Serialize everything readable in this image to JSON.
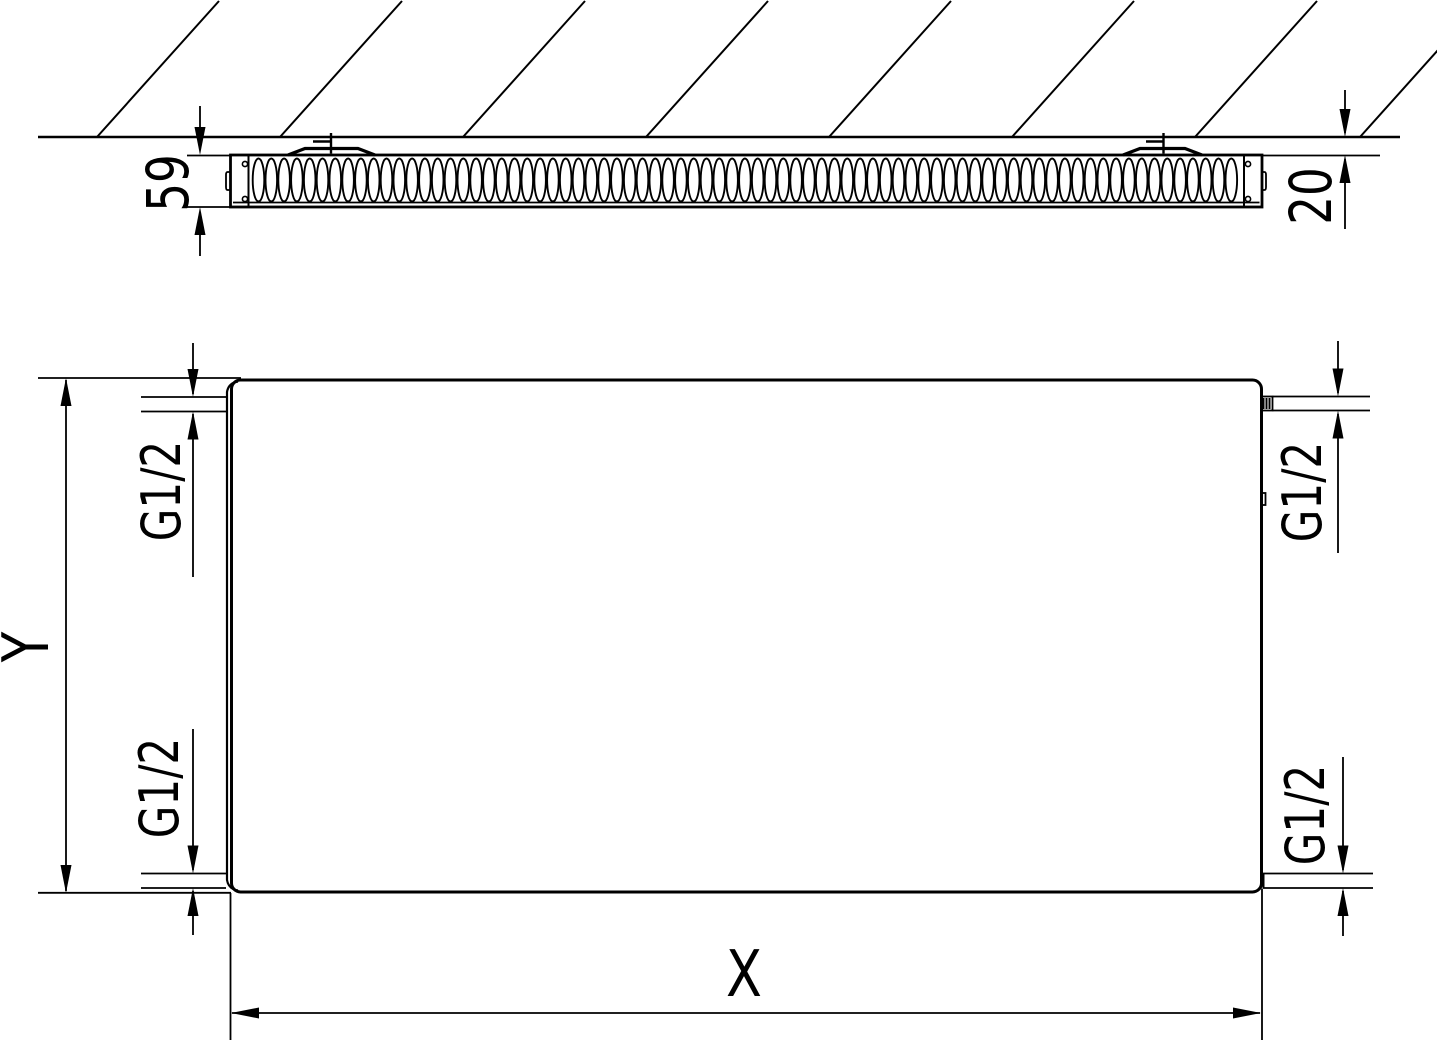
{
  "drawing": {
    "background_color": "#ffffff",
    "line_color": "#000000",
    "top_view": {
      "depth_label": "59",
      "wall_gap_label": "20"
    },
    "front_view": {
      "height_label": "Y",
      "width_label": "X",
      "connections": {
        "top_left_label": "G1/2",
        "top_right_label": "G1/2",
        "bottom_left_label": "G1/2",
        "bottom_right_label": "G1/2"
      }
    }
  }
}
